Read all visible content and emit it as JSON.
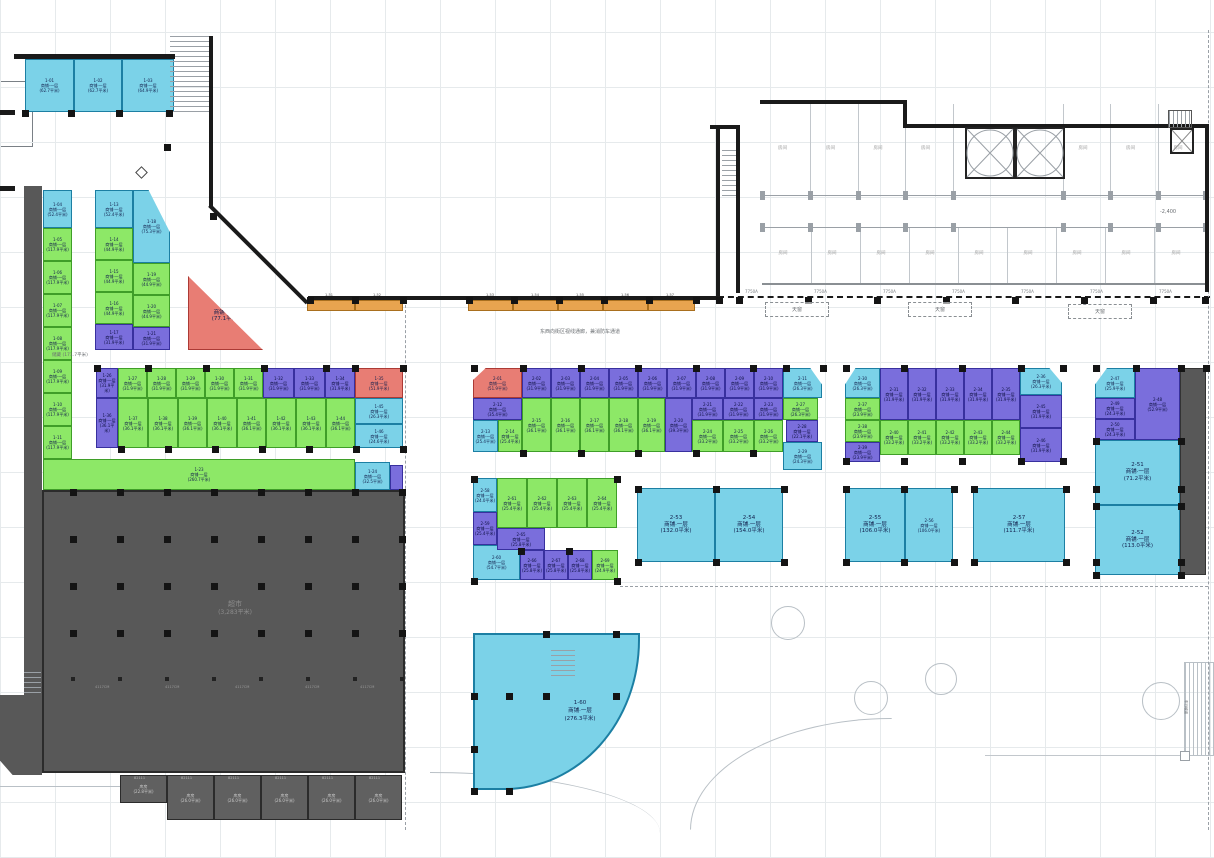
{
  "defaults": {
    "unit_type": "商铺·一层",
    "area_unit": "平米"
  },
  "annotations": {
    "street_note": "东西向街区视线通廊，兼消防车通道",
    "storage_name": "储藏",
    "storage_area": "(171.7平米)",
    "supermarket_name": "超市",
    "supermarket_area": "(3,283平米)",
    "elevation": "-2,400",
    "dim_label": "4117CM",
    "ramp_label": "车行坡道"
  },
  "colonnade": {
    "label": "7750A",
    "skylight": "天窗"
  },
  "hotel": {
    "room_label": "房间",
    "rooms_top_count": 7,
    "rooms_bottom_count": 9
  },
  "curved_unit": {
    "id": "1-60",
    "type": "商铺·一层",
    "area": "276.3"
  },
  "gray_rooms": {
    "code": "82111",
    "items": [
      {
        "label": "库房",
        "area": "22.8"
      },
      {
        "label": "库房",
        "area": "26.0"
      },
      {
        "label": "库房",
        "area": "26.0"
      },
      {
        "label": "库房",
        "area": "26.0"
      },
      {
        "label": "库房",
        "area": "26.0"
      },
      {
        "label": "库房",
        "area": "26.0"
      }
    ]
  },
  "units": [
    [
      "1-01",
      "cyan",
      25,
      59,
      49,
      53,
      "62.7"
    ],
    [
      "1-02",
      "cyan",
      74,
      59,
      48,
      53,
      "62.7"
    ],
    [
      "1-03",
      "cyan",
      122,
      59,
      52,
      53,
      "64.9"
    ],
    [
      "1-04",
      "cyan",
      43,
      190,
      29,
      38,
      "52.4"
    ],
    [
      "1-05",
      "green",
      43,
      228,
      29,
      33,
      "117.9"
    ],
    [
      "1-06",
      "green",
      43,
      261,
      29,
      33,
      "117.9"
    ],
    [
      "1-07",
      "green",
      43,
      294,
      29,
      33,
      "117.9"
    ],
    [
      "1-08",
      "green",
      43,
      327,
      29,
      33,
      "117.9"
    ],
    [
      "1-09",
      "green",
      43,
      360,
      29,
      33,
      "117.9"
    ],
    [
      "1-10",
      "green",
      43,
      393,
      29,
      33,
      "117.9"
    ],
    [
      "1-11",
      "green",
      43,
      426,
      29,
      33,
      "117.9"
    ],
    [
      "1-13",
      "cyan",
      95,
      190,
      38,
      38,
      "52.4"
    ],
    [
      "1-14",
      "green",
      95,
      228,
      38,
      32,
      "44.9"
    ],
    [
      "1-15",
      "green",
      95,
      260,
      38,
      32,
      "44.9"
    ],
    [
      "1-16",
      "green",
      95,
      292,
      38,
      32,
      "44.9"
    ],
    [
      "1-17",
      "purple",
      95,
      324,
      38,
      26,
      "31.9"
    ],
    [
      "1-18",
      "cyan",
      133,
      190,
      37,
      73,
      "75.3",
      "tr"
    ],
    [
      "1-19",
      "green",
      133,
      263,
      37,
      32,
      "44.9"
    ],
    [
      "1-20",
      "green",
      133,
      295,
      37,
      32,
      "44.9"
    ],
    [
      "1-21",
      "purple",
      133,
      327,
      37,
      23,
      "31.9"
    ],
    [
      "1-22",
      "red",
      188,
      276,
      75,
      74,
      "77.1",
      "tri"
    ],
    [
      "1-26",
      "purple",
      96,
      368,
      22,
      30,
      "31.9"
    ],
    [
      "1-27",
      "green",
      118,
      368,
      29,
      30,
      "31.9"
    ],
    [
      "1-28",
      "green",
      147,
      368,
      29,
      30,
      "31.9"
    ],
    [
      "1-29",
      "green",
      176,
      368,
      29,
      30,
      "31.9"
    ],
    [
      "1-30",
      "green",
      205,
      368,
      29,
      30,
      "31.9"
    ],
    [
      "1-31",
      "green",
      234,
      368,
      29,
      30,
      "31.9"
    ],
    [
      "1-32",
      "purple",
      263,
      368,
      31,
      30,
      "31.9"
    ],
    [
      "1-33",
      "purple",
      294,
      368,
      31,
      30,
      "31.9"
    ],
    [
      "1-34",
      "purple",
      325,
      368,
      30,
      30,
      "31.9"
    ],
    [
      "1-35",
      "red",
      355,
      368,
      48,
      30,
      "51.9"
    ],
    [
      "1-36",
      "purple",
      96,
      398,
      22,
      50,
      "36.1"
    ],
    [
      "1-37",
      "green",
      118,
      398,
      30,
      50,
      "36.1"
    ],
    [
      "1-38",
      "green",
      148,
      398,
      30,
      50,
      "36.1"
    ],
    [
      "1-39",
      "green",
      178,
      398,
      29,
      50,
      "36.1"
    ],
    [
      "1-40",
      "green",
      207,
      398,
      30,
      50,
      "36.1"
    ],
    [
      "1-41",
      "green",
      237,
      398,
      29,
      50,
      "36.1"
    ],
    [
      "1-42",
      "green",
      266,
      398,
      30,
      50,
      "36.1"
    ],
    [
      "1-43",
      "green",
      296,
      398,
      30,
      50,
      "36.1"
    ],
    [
      "1-44",
      "green",
      326,
      398,
      29,
      50,
      "36.1"
    ],
    [
      "1-45",
      "cyan",
      355,
      398,
      48,
      26,
      "26.3"
    ],
    [
      "1-46",
      "cyan",
      355,
      424,
      48,
      24,
      "24.6"
    ],
    [
      "1-23",
      "green",
      43,
      459,
      312,
      31,
      "260.7"
    ],
    [
      "1-24",
      "cyan",
      355,
      462,
      35,
      28,
      "32.5"
    ],
    [
      "1-25",
      "purple",
      390,
      465,
      13,
      25,
      "12.8"
    ],
    [
      "1-51",
      "orange",
      307,
      300,
      48,
      11,
      "12.1"
    ],
    [
      "1-52",
      "orange",
      355,
      300,
      48,
      11,
      "12.1"
    ],
    [
      "1-53",
      "orange",
      468,
      300,
      45,
      11,
      "12.1"
    ],
    [
      "1-54",
      "orange",
      513,
      300,
      45,
      11,
      "12.1"
    ],
    [
      "1-55",
      "orange",
      558,
      300,
      45,
      11,
      "12.1"
    ],
    [
      "1-56",
      "orange",
      603,
      300,
      45,
      11,
      "12.1"
    ],
    [
      "1-57",
      "orange",
      648,
      300,
      47,
      11,
      "12.1"
    ],
    [
      "2-01",
      "red",
      473,
      368,
      49,
      30,
      "51.9",
      "rc"
    ],
    [
      "2-02",
      "purple",
      522,
      368,
      29,
      30,
      "31.9"
    ],
    [
      "2-03",
      "purple",
      551,
      368,
      29,
      30,
      "31.9"
    ],
    [
      "2-04",
      "purple",
      580,
      368,
      29,
      30,
      "31.9"
    ],
    [
      "2-05",
      "purple",
      609,
      368,
      29,
      30,
      "31.9"
    ],
    [
      "2-06",
      "purple",
      638,
      368,
      29,
      30,
      "31.9"
    ],
    [
      "2-07",
      "purple",
      667,
      368,
      29,
      30,
      "31.9"
    ],
    [
      "2-08",
      "purple",
      696,
      368,
      29,
      30,
      "31.9"
    ],
    [
      "2-09",
      "purple",
      725,
      368,
      29,
      30,
      "31.9"
    ],
    [
      "2-10",
      "purple",
      754,
      368,
      29,
      30,
      "31.9"
    ],
    [
      "2-11",
      "cyan",
      783,
      368,
      39,
      30,
      "26.3",
      "cr"
    ],
    [
      "2-12",
      "purple",
      473,
      398,
      49,
      22,
      "35.4"
    ],
    [
      "2-13",
      "cyan",
      473,
      420,
      25,
      32,
      "25.4"
    ],
    [
      "2-14",
      "green",
      498,
      420,
      24,
      32,
      "25.4"
    ],
    [
      "2-15",
      "green",
      522,
      398,
      29,
      54,
      "36.1"
    ],
    [
      "2-16",
      "green",
      551,
      398,
      29,
      54,
      "36.1"
    ],
    [
      "2-17",
      "green",
      580,
      398,
      29,
      54,
      "36.1"
    ],
    [
      "2-18",
      "green",
      609,
      398,
      29,
      54,
      "36.1"
    ],
    [
      "2-19",
      "green",
      638,
      398,
      27,
      54,
      "36.1"
    ],
    [
      "2-20",
      "purple",
      665,
      398,
      27,
      54,
      "39.3"
    ],
    [
      "2-21",
      "purple",
      692,
      398,
      31,
      22,
      "31.9"
    ],
    [
      "2-22",
      "purple",
      723,
      398,
      31,
      22,
      "31.9"
    ],
    [
      "2-23",
      "purple",
      754,
      398,
      29,
      22,
      "31.9"
    ],
    [
      "2-24",
      "green",
      692,
      420,
      31,
      32,
      "33.2"
    ],
    [
      "2-25",
      "green",
      723,
      420,
      31,
      32,
      "33.2"
    ],
    [
      "2-26",
      "green",
      754,
      420,
      29,
      32,
      "33.2"
    ],
    [
      "2-27",
      "green",
      783,
      398,
      35,
      22,
      "26.3"
    ],
    [
      "2-28",
      "purple",
      786,
      420,
      32,
      22,
      "22.1"
    ],
    [
      "2-29",
      "cyan",
      783,
      442,
      39,
      28,
      "24.3"
    ],
    [
      "2-30",
      "cyan",
      845,
      368,
      35,
      30,
      "26.3",
      "cl"
    ],
    [
      "2-31",
      "purple",
      880,
      368,
      28,
      52,
      "31.9"
    ],
    [
      "2-32",
      "purple",
      908,
      368,
      28,
      52,
      "31.9"
    ],
    [
      "2-33",
      "purple",
      936,
      368,
      28,
      52,
      "31.9"
    ],
    [
      "2-34",
      "purple",
      964,
      368,
      28,
      52,
      "31.9"
    ],
    [
      "2-35",
      "purple",
      992,
      368,
      28,
      52,
      "31.9"
    ],
    [
      "2-36",
      "cyan",
      1020,
      368,
      42,
      27,
      "26.3",
      "cr"
    ],
    [
      "2-37",
      "green",
      845,
      398,
      35,
      22,
      "23.9"
    ],
    [
      "2-38",
      "green",
      845,
      420,
      35,
      22,
      "23.9"
    ],
    [
      "2-39",
      "purple",
      845,
      442,
      35,
      20,
      "23.9"
    ],
    [
      "2-40",
      "green",
      880,
      420,
      28,
      35,
      "33.2"
    ],
    [
      "2-41",
      "green",
      908,
      420,
      28,
      35,
      "33.2"
    ],
    [
      "2-42",
      "green",
      936,
      420,
      28,
      35,
      "33.2"
    ],
    [
      "2-43",
      "green",
      964,
      420,
      28,
      35,
      "33.2"
    ],
    [
      "2-44",
      "green",
      992,
      420,
      28,
      35,
      "33.2"
    ],
    [
      "2-45",
      "purple",
      1020,
      395,
      42,
      33,
      "31.9"
    ],
    [
      "2-46",
      "purple",
      1020,
      428,
      42,
      34,
      "31.9"
    ],
    [
      "2-47",
      "cyan",
      1095,
      368,
      40,
      30,
      "25.9",
      "cl"
    ],
    [
      "2-48",
      "purple",
      1135,
      368,
      45,
      72,
      "52.9"
    ],
    [
      "2-49",
      "purple",
      1095,
      398,
      40,
      21,
      "24.3"
    ],
    [
      "2-50",
      "purple",
      1095,
      419,
      40,
      21,
      "24.3"
    ],
    [
      "2-51",
      "cyan",
      1095,
      440,
      85,
      65,
      "71.2"
    ],
    [
      "2-52",
      "cyan",
      1095,
      505,
      85,
      70,
      "113.0"
    ],
    [
      "",
      "dark",
      1180,
      368,
      26,
      207,
      ""
    ],
    [
      "2-53",
      "cyan",
      637,
      488,
      78,
      74,
      "132.0"
    ],
    [
      "2-54",
      "cyan",
      715,
      488,
      68,
      74,
      "154.0"
    ],
    [
      "2-55",
      "cyan",
      845,
      488,
      60,
      74,
      "106.0"
    ],
    [
      "2-56",
      "cyan",
      905,
      488,
      48,
      74,
      "106.0"
    ],
    [
      "2-57",
      "cyan",
      973,
      488,
      92,
      74,
      "111.7"
    ],
    [
      "2-58",
      "cyan",
      473,
      478,
      24,
      34,
      "24.0"
    ],
    [
      "2-59",
      "purple",
      473,
      512,
      24,
      33,
      "25.4"
    ],
    [
      "2-60",
      "cyan",
      473,
      545,
      47,
      35,
      "54.7"
    ],
    [
      "2-61",
      "green",
      497,
      478,
      30,
      50,
      "25.4"
    ],
    [
      "2-62",
      "green",
      527,
      478,
      30,
      50,
      "25.4"
    ],
    [
      "2-63",
      "green",
      557,
      478,
      30,
      50,
      "25.4"
    ],
    [
      "2-64",
      "green",
      587,
      478,
      30,
      50,
      "25.4"
    ],
    [
      "2-65",
      "purple",
      497,
      528,
      48,
      22,
      "25.8"
    ],
    [
      "2-66",
      "purple",
      520,
      550,
      24,
      30,
      "25.8"
    ],
    [
      "2-67",
      "purple",
      544,
      550,
      24,
      30,
      "25.8"
    ],
    [
      "2-68",
      "purple",
      568,
      550,
      24,
      30,
      "25.8"
    ],
    [
      "2-69",
      "green",
      592,
      550,
      26,
      30,
      "24.9"
    ]
  ]
}
